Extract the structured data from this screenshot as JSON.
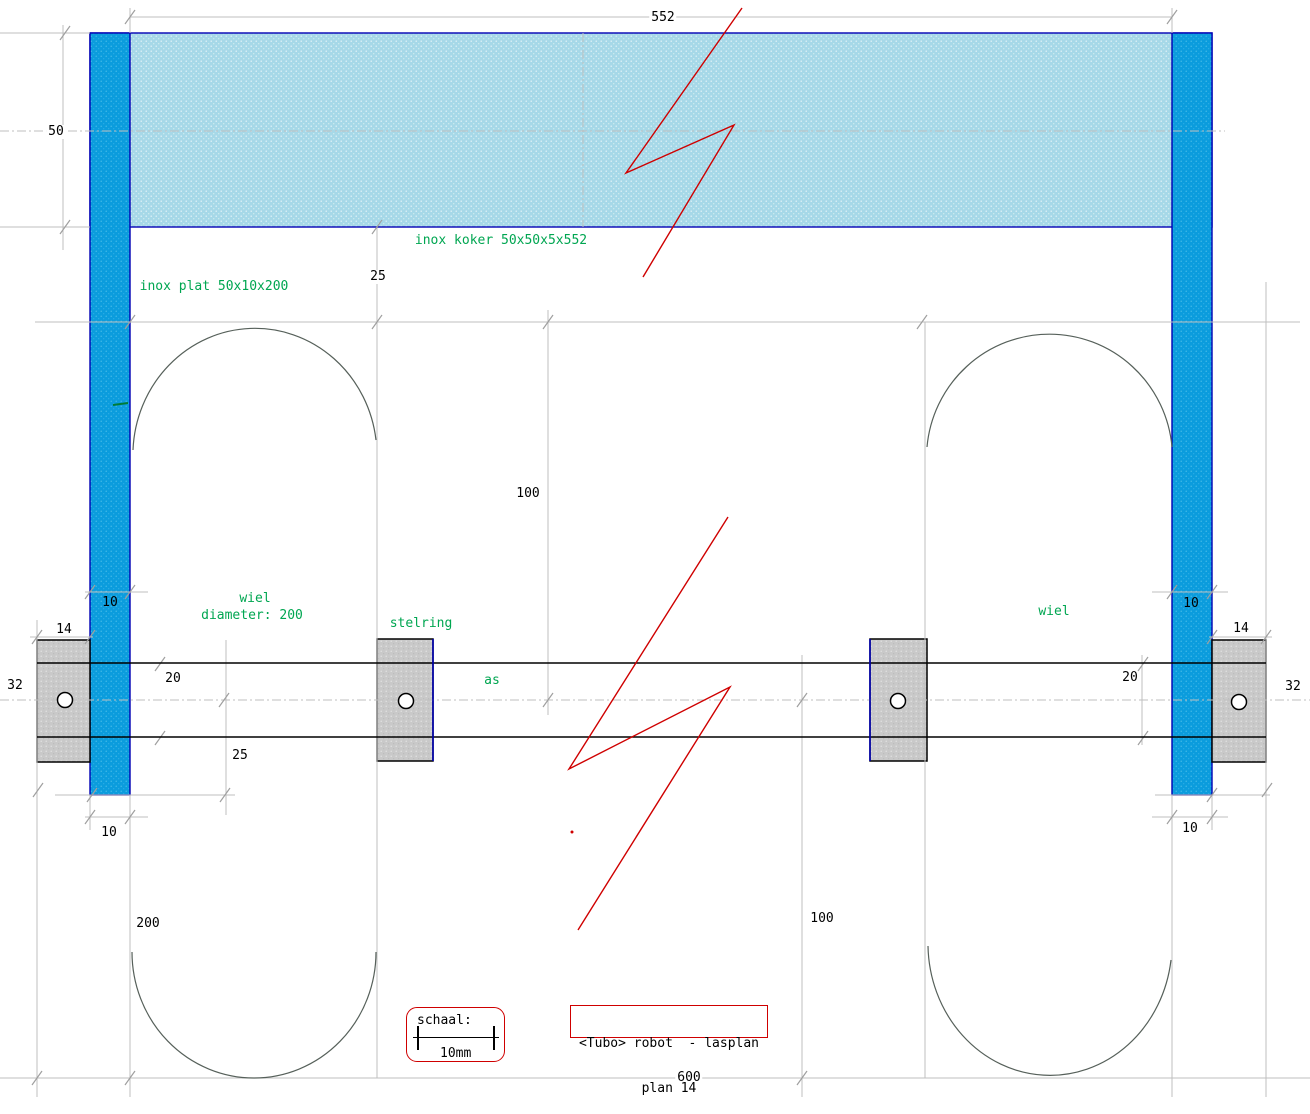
{
  "labels": {
    "koker": "inox koker 50x50x5x552",
    "plat": "inox plat 50x10x200",
    "wiel_left": "wiel",
    "wiel_diameter": "diameter: 200",
    "stelring": "stelring",
    "as": "as",
    "wiel_right": "wiel"
  },
  "dims": {
    "d552": "552",
    "d50": "50",
    "d25_top": "25",
    "d100_top": "100",
    "d10_top_left": "10",
    "d14_left": "14",
    "d32_left": "32",
    "d20_left": "20",
    "d25_left": "25",
    "d10_bottom_left": "10",
    "d200": "200",
    "d100_bottom": "100",
    "d20_right": "20",
    "d10_top_right": "10",
    "d14_right": "14",
    "d32_right": "32",
    "d10_bottom_right": "10",
    "d600": "600"
  },
  "title_block": {
    "line1": "<Tubo> robot  - lasplan",
    "line2": "plan 14"
  },
  "scale_block": {
    "label": "schaal:",
    "value": "10mm"
  },
  "colors": {
    "bar_blue": "#0b9cdd",
    "koker_blue": "#a6d8e8",
    "outline_navy": "#0000b4",
    "steel_gray": "#c9c9c9",
    "annotation_green": "#00a651",
    "accent_red": "#cf0000",
    "construction_gray": "#bfbfbf"
  }
}
